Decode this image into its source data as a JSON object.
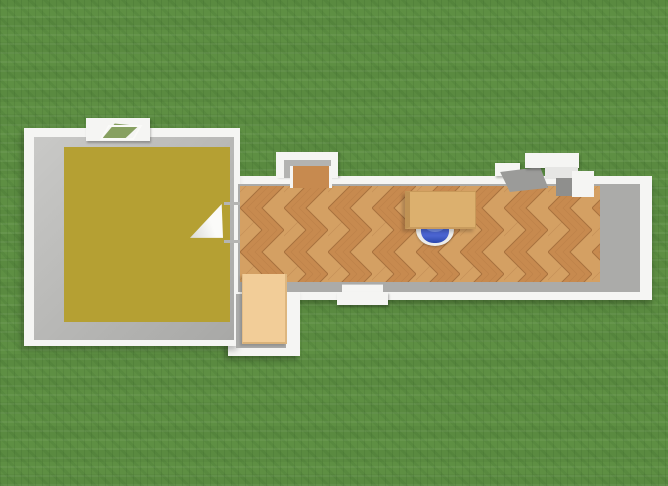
{
  "scene": {
    "title": "Top-down 3D floor plan render on a grass lawn",
    "view": "top-down 3D dollhouse view",
    "environment": "green grass lawn background with repeating texture"
  },
  "colors": {
    "grass": "#5e8f43",
    "glass_green": "#87a061",
    "wall_white": "#f5f5f3",
    "wall_inner_gray": "#ababa9",
    "landing_gray": "#9b9b99",
    "bedroom_floor": "#b5a033",
    "parquet_base": "#c78a4f",
    "parquet_light": "#d4a063",
    "parquet_line": "#a8713e",
    "desk_wood": "#dcb06e",
    "wardrobe_wood": "#f2cd98",
    "chair_blue": "#4a64d0",
    "chair_blue_dark": "#2c47ad",
    "chair_blue_light": "#7e97e8"
  },
  "rooms": [
    {
      "id": "left-room",
      "name": "Large square room",
      "floor": "mustard-yellow",
      "position": "left"
    },
    {
      "id": "hallway",
      "name": "Long hallway",
      "floor": "herringbone parquet",
      "position": "center-right"
    },
    {
      "id": "alcove",
      "name": "Small alcove",
      "floor": "parquet",
      "position": "bottom-left of hallway"
    }
  ],
  "openings": [
    {
      "id": "window-top-room",
      "name": "Window on top wall of left room"
    },
    {
      "id": "door-left-room",
      "name": "Open door leaf between left room and hallway"
    },
    {
      "id": "porch-door-top",
      "name": "Doorway with porch frame on top hallway wall"
    },
    {
      "id": "entry-landing",
      "name": "Entry landing with step slabs, top right of hallway"
    },
    {
      "id": "window-bottom-hall",
      "name": "Window on bottom hallway wall"
    }
  ],
  "furniture": [
    {
      "id": "desk",
      "name": "Light wooden desk",
      "room": "hallway"
    },
    {
      "id": "office-chair",
      "name": "Blue office chair tucked under desk",
      "room": "hallway"
    },
    {
      "id": "wardrobe",
      "name": "Light wood wardrobe",
      "room": "alcove"
    }
  ]
}
